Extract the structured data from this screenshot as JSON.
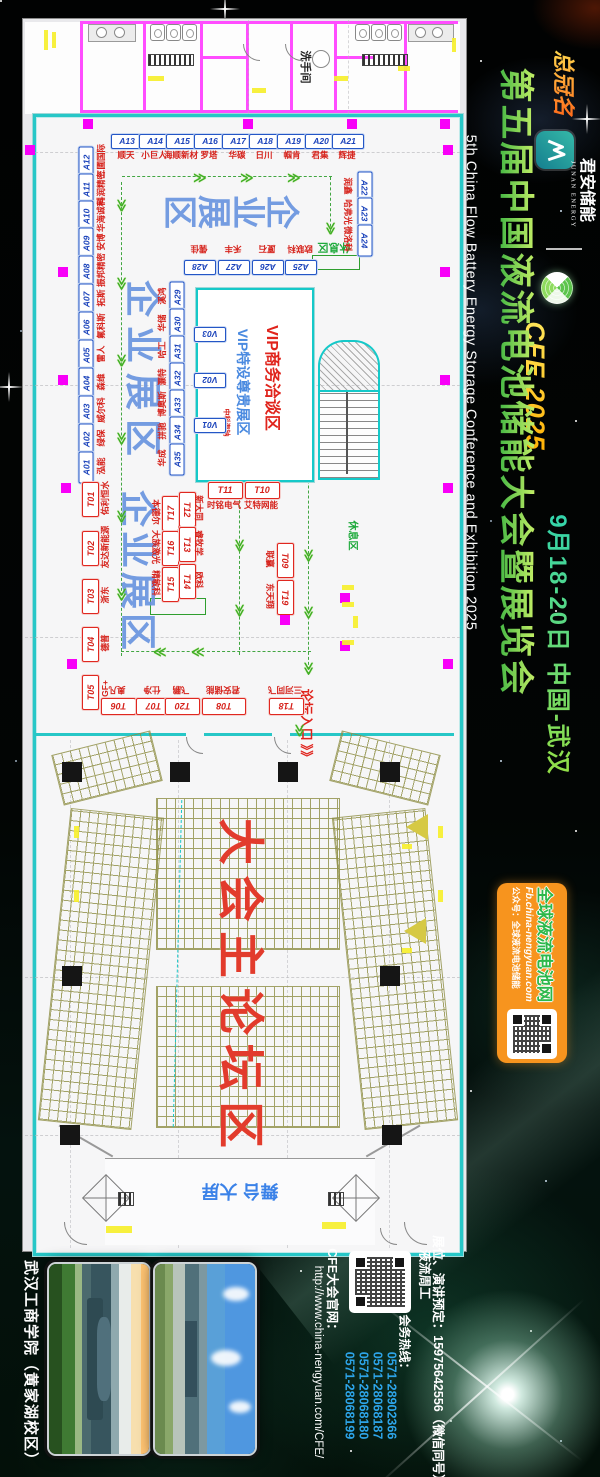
{
  "sidebar": {
    "sponsor_prefix": "总冠名",
    "brand_cn": "君安储能",
    "brand_en": "JUNAN ENERGY",
    "event_code": "CFE 2025",
    "title_cn": "第五届中国液流电池储能大会暨展览会",
    "title_en": "5th China Flow Battery Energy Storage Conference and Exhibition 2025",
    "date_location": "9月18-20日 中国-武汉",
    "media_box": {
      "name": "全球液流电池网",
      "url": "Fb.china-nengyuan.com",
      "wechat": "公众号：全球液流电池储能"
    }
  },
  "floorplan": {
    "labels": {
      "restroom": "洗手间",
      "zone_enterprise": "企业展区",
      "rest_area": "休息区",
      "vip_meeting": "VIP商务洽谈区",
      "vip_booth_zone": "VIP特设尊贵展区",
      "vip_company": "中科海钠",
      "forum_entrance": "论坛入口",
      "forum_entrance_arrows": "》》",
      "main_forum": "大会主论坛区",
      "stage": "舞台 大屏"
    },
    "booths": [
      {
        "id": "A13",
        "n": "顺天",
        "t": "b",
        "x": 126,
        "y": 140,
        "r": 0,
        "nx": 126,
        "ny": 155,
        "nr": 0
      },
      {
        "id": "A14",
        "n": "小巨人",
        "t": "b",
        "x": 154,
        "y": 140,
        "r": 0,
        "nx": 154,
        "ny": 155,
        "nr": 0
      },
      {
        "id": "A15",
        "n": "海顺新材",
        "t": "b",
        "x": 181,
        "y": 140,
        "r": 0,
        "nx": 181,
        "ny": 155,
        "nr": 0
      },
      {
        "id": "A16",
        "n": "罗塔",
        "t": "b",
        "x": 209,
        "y": 140,
        "r": 0,
        "nx": 209,
        "ny": 155,
        "nr": 0
      },
      {
        "id": "A17",
        "n": "华碳",
        "t": "b",
        "x": 237,
        "y": 140,
        "r": 0,
        "nx": 237,
        "ny": 155,
        "nr": 0
      },
      {
        "id": "A18",
        "n": "日川",
        "t": "b",
        "x": 264,
        "y": 140,
        "r": 0,
        "nx": 264,
        "ny": 155,
        "nr": 0
      },
      {
        "id": "A19",
        "n": "帼肯",
        "t": "b",
        "x": 292,
        "y": 140,
        "r": 0,
        "nx": 292,
        "ny": 155,
        "nr": 0
      },
      {
        "id": "A20",
        "n": "君集",
        "t": "b",
        "x": 320,
        "y": 140,
        "r": 0,
        "nx": 320,
        "ny": 155,
        "nr": 0
      },
      {
        "id": "A21",
        "n": "辉捷",
        "t": "b",
        "x": 347,
        "y": 140,
        "r": 0,
        "nx": 347,
        "ny": 155,
        "nr": 0
      },
      {
        "id": "A12",
        "n": "三圃国际",
        "t": "b",
        "x": 85,
        "y": 161,
        "r": -90,
        "nx": 101,
        "ny": 161,
        "nr": -90
      },
      {
        "id": "A11",
        "n": "科润精密",
        "t": "b",
        "x": 85,
        "y": 188,
        "r": -90,
        "nx": 101,
        "ny": 188,
        "nr": -90
      },
      {
        "id": "A10",
        "n": "华海诚科",
        "t": "b",
        "x": 85,
        "y": 215,
        "r": -90,
        "nx": 101,
        "ny": 215,
        "nr": -90
      },
      {
        "id": "A09",
        "n": "安博",
        "t": "b",
        "x": 85,
        "y": 242,
        "r": -90,
        "nx": 101,
        "ny": 242,
        "nr": -90
      },
      {
        "id": "A08",
        "n": "振邦精密",
        "t": "b",
        "x": 85,
        "y": 270,
        "r": -90,
        "nx": 101,
        "ny": 270,
        "nr": -90
      },
      {
        "id": "A07",
        "n": "拓斯",
        "t": "b",
        "x": 85,
        "y": 298,
        "r": -90,
        "nx": 101,
        "ny": 298,
        "nr": -90
      },
      {
        "id": "A06",
        "n": "氟科斯",
        "t": "b",
        "x": 85,
        "y": 326,
        "r": -90,
        "nx": 101,
        "ny": 326,
        "nr": -90
      },
      {
        "id": "A05",
        "n": "雷人",
        "t": "b",
        "x": 85,
        "y": 354,
        "r": -90,
        "nx": 101,
        "ny": 354,
        "nr": -90
      },
      {
        "id": "A04",
        "n": "森维",
        "t": "b",
        "x": 85,
        "y": 382,
        "r": -90,
        "nx": 101,
        "ny": 382,
        "nr": -90
      },
      {
        "id": "A03",
        "n": "威尔科",
        "t": "b",
        "x": 85,
        "y": 410,
        "r": -90,
        "nx": 101,
        "ny": 410,
        "nr": -90
      },
      {
        "id": "A02",
        "n": "绿保",
        "t": "b",
        "x": 85,
        "y": 438,
        "r": -90,
        "nx": 101,
        "ny": 438,
        "nr": -90
      },
      {
        "id": "A01",
        "n": "泓能",
        "t": "b",
        "x": 85,
        "y": 466,
        "r": -90,
        "nx": 101,
        "ny": 466,
        "nr": -90
      },
      {
        "id": "A22",
        "n": "润鑫",
        "t": "b",
        "x": 364,
        "y": 186,
        "r": 90,
        "nx": 348,
        "ny": 186,
        "nr": 90
      },
      {
        "id": "A23",
        "n": "哈弗光",
        "t": "b",
        "x": 364,
        "y": 212,
        "r": 90,
        "nx": 348,
        "ny": 212,
        "nr": 90
      },
      {
        "id": "A24",
        "n": "微洛科",
        "t": "b",
        "x": 364,
        "y": 239,
        "r": 90,
        "nx": 348,
        "ny": 239,
        "nr": 90
      },
      {
        "id": "A28",
        "n": "儒佳",
        "t": "b",
        "x": 199,
        "y": 266,
        "r": 180,
        "nx": 199,
        "ny": 249,
        "nr": 180
      },
      {
        "id": "A27",
        "n": "禾丰",
        "t": "b",
        "x": 233,
        "y": 266,
        "r": 180,
        "nx": 233,
        "ny": 249,
        "nr": 180
      },
      {
        "id": "A26",
        "n": "厦石",
        "t": "b",
        "x": 267,
        "y": 266,
        "r": 180,
        "nx": 267,
        "ny": 249,
        "nr": 180
      },
      {
        "id": "A25",
        "n": "欧联科",
        "t": "b",
        "x": 300,
        "y": 266,
        "r": 180,
        "nx": 300,
        "ny": 249,
        "nr": 180
      },
      {
        "id": "A29",
        "n": "溪鸿",
        "t": "b",
        "x": 176,
        "y": 296,
        "r": -90,
        "nx": 162,
        "ny": 296,
        "nr": -90
      },
      {
        "id": "A30",
        "n": "华储",
        "t": "b",
        "x": 176,
        "y": 323,
        "r": -90,
        "nx": 162,
        "ny": 323,
        "nr": -90
      },
      {
        "id": "A31",
        "n": "哈工",
        "t": "b",
        "x": 176,
        "y": 350,
        "r": -90,
        "nx": 162,
        "ny": 350,
        "nr": -90
      },
      {
        "id": "A32",
        "n": "灏特",
        "t": "b",
        "x": 176,
        "y": 377,
        "r": -90,
        "nx": 162,
        "ny": 377,
        "nr": -90
      },
      {
        "id": "A33",
        "n": "博奥斯",
        "t": "b",
        "x": 176,
        "y": 404,
        "r": -90,
        "nx": 162,
        "ny": 404,
        "nr": -90
      },
      {
        "id": "A34",
        "n": "拼驰",
        "t": "b",
        "x": 176,
        "y": 431,
        "r": -90,
        "nx": 162,
        "ny": 431,
        "nr": -90
      },
      {
        "id": "A35",
        "n": "华成",
        "t": "b",
        "x": 176,
        "y": 458,
        "r": -90,
        "nx": 162,
        "ny": 458,
        "nr": -90
      },
      {
        "id": "V03",
        "t": "b",
        "x": 209,
        "y": 333,
        "r": 180
      },
      {
        "id": "V02",
        "t": "b",
        "x": 209,
        "y": 379,
        "r": 180
      },
      {
        "id": "V01",
        "t": "b",
        "x": 209,
        "y": 424,
        "r": 180
      },
      {
        "id": "T11",
        "n": "时铭电气",
        "t": "r",
        "x": 224,
        "y": 489,
        "r": 0,
        "nx": 224,
        "ny": 505,
        "nr": 0
      },
      {
        "id": "T10",
        "n": "艾特网能",
        "t": "r",
        "x": 261,
        "y": 489,
        "r": 0,
        "nx": 261,
        "ny": 505,
        "nr": 0
      },
      {
        "id": "T17",
        "n": "本德尔",
        "t": "r",
        "x": 169,
        "y": 512,
        "r": -90,
        "nx": 156,
        "ny": 512,
        "nr": 90
      },
      {
        "id": "T12",
        "n": "新大同",
        "t": "r",
        "x": 186,
        "y": 508,
        "r": 90,
        "nx": 199,
        "ny": 508,
        "nr": 90
      },
      {
        "id": "T16",
        "n": "大族激光",
        "t": "r",
        "x": 169,
        "y": 547,
        "r": -90,
        "nx": 156,
        "ny": 547,
        "nr": 90
      },
      {
        "id": "T13",
        "n": "睿牧学",
        "t": "r",
        "x": 186,
        "y": 543,
        "r": 90,
        "nx": 199,
        "ny": 543,
        "nr": 90
      },
      {
        "id": "T15",
        "n": "精敏科",
        "t": "r",
        "x": 169,
        "y": 583,
        "r": -90,
        "nx": 156,
        "ny": 583,
        "nr": 90
      },
      {
        "id": "T14",
        "n": "欧科",
        "t": "r",
        "x": 186,
        "y": 580,
        "r": 90,
        "nx": 199,
        "ny": 580,
        "nr": 90
      },
      {
        "id": "T09",
        "n": "联赢",
        "t": "r",
        "x": 284,
        "y": 559,
        "r": 90,
        "nx": 270,
        "ny": 559,
        "nr": 90
      },
      {
        "id": "T19",
        "n": "东天翔",
        "t": "r",
        "x": 284,
        "y": 596,
        "r": 90,
        "nx": 270,
        "ny": 596,
        "nr": 90
      },
      {
        "id": "T01",
        "n": "佑利恒水",
        "t": "r",
        "x": 89,
        "y": 498,
        "r": -90,
        "nx": 105,
        "ny": 498,
        "nr": -90
      },
      {
        "id": "T02",
        "n": "友达新能源",
        "t": "r",
        "x": 89,
        "y": 547,
        "r": -90,
        "nx": 105,
        "ny": 547,
        "nr": -90
      },
      {
        "id": "T03",
        "n": "浙东",
        "t": "r",
        "x": 89,
        "y": 595,
        "r": -90,
        "nx": 105,
        "ny": 595,
        "nr": -90
      },
      {
        "id": "T04",
        "n": "德普",
        "t": "r",
        "x": 89,
        "y": 643,
        "r": -90,
        "nx": 105,
        "ny": 643,
        "nr": -90
      },
      {
        "id": "T05",
        "n": "+GF+",
        "t": "r",
        "x": 89,
        "y": 691,
        "r": -90,
        "nx": 105,
        "ny": 691,
        "nr": -90
      },
      {
        "id": "T06",
        "n": "奥凡",
        "t": "r",
        "x": 117,
        "y": 705,
        "r": 180,
        "nx": 117,
        "ny": 690,
        "nr": 180
      },
      {
        "id": "T07",
        "n": "仕净",
        "t": "r",
        "x": 152,
        "y": 705,
        "r": 180,
        "nx": 152,
        "ny": 690,
        "nr": 180
      },
      {
        "id": "T20",
        "n": "飞鹏",
        "t": "r",
        "x": 181,
        "y": 705,
        "r": 180,
        "nx": 181,
        "ny": 690,
        "nr": 180
      },
      {
        "id": "T08",
        "n": "君安储能",
        "t": "r",
        "x": 223,
        "y": 705,
        "r": 180,
        "w": 42,
        "nx": 223,
        "ny": 690,
        "nr": 180
      },
      {
        "id": "T18",
        "n": "三河同飞",
        "t": "r",
        "x": 285,
        "y": 705,
        "r": 180,
        "nx": 285,
        "ny": 690,
        "nr": 180
      }
    ],
    "arrows": [
      {
        "x": 200,
        "y": 177,
        "d": "r"
      },
      {
        "x": 247,
        "y": 177,
        "d": "r"
      },
      {
        "x": 294,
        "y": 177,
        "d": "r"
      },
      {
        "x": 331,
        "y": 228,
        "d": "d"
      },
      {
        "x": 122,
        "y": 205,
        "d": "d"
      },
      {
        "x": 122,
        "y": 283,
        "d": "d"
      },
      {
        "x": 122,
        "y": 360,
        "d": "d"
      },
      {
        "x": 122,
        "y": 438,
        "d": "d"
      },
      {
        "x": 122,
        "y": 516,
        "d": "d"
      },
      {
        "x": 122,
        "y": 594,
        "d": "d"
      },
      {
        "x": 160,
        "y": 652,
        "d": "l"
      },
      {
        "x": 198,
        "y": 652,
        "d": "l"
      },
      {
        "x": 240,
        "y": 545,
        "d": "d"
      },
      {
        "x": 240,
        "y": 610,
        "d": "d"
      },
      {
        "x": 309,
        "y": 555,
        "d": "d"
      },
      {
        "x": 309,
        "y": 612,
        "d": "d"
      },
      {
        "x": 309,
        "y": 668,
        "d": "d"
      },
      {
        "x": 300,
        "y": 730,
        "d": "d"
      }
    ]
  },
  "footer": {
    "venue": "武汉工商学院（黄家湖校区）",
    "website_label": "CFE大会官网：",
    "website_url": "http://www.china-nengyuan.com/CFE/",
    "booking_line": "展位、演讲预定：15975642556（微信同号）",
    "contact_person": "液流周工",
    "hotline_label": "会务热线：",
    "phones": [
      "0571-28902366",
      "0571-28068187",
      "0571-28068180",
      "0571-28068199"
    ]
  },
  "colors": {
    "accent_green": "#4db848",
    "accent_orange": "#f7941e",
    "booth_blue": "#1b43bb",
    "booth_red": "#d6231c",
    "hotline_blue": "#2da4e8"
  }
}
